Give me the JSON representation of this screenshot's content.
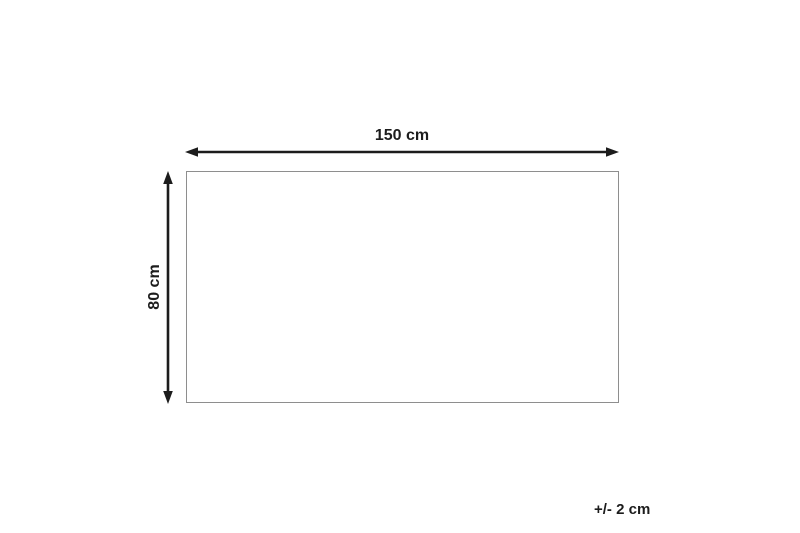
{
  "diagram": {
    "width_label": "150 cm",
    "height_label": "80 cm",
    "tolerance_label": "+/- 2 cm"
  },
  "colors": {
    "arrow": "#1c1c1c",
    "rect_border": "#8e8e8e",
    "text": "#1c1c1c",
    "background": "#ffffff"
  }
}
